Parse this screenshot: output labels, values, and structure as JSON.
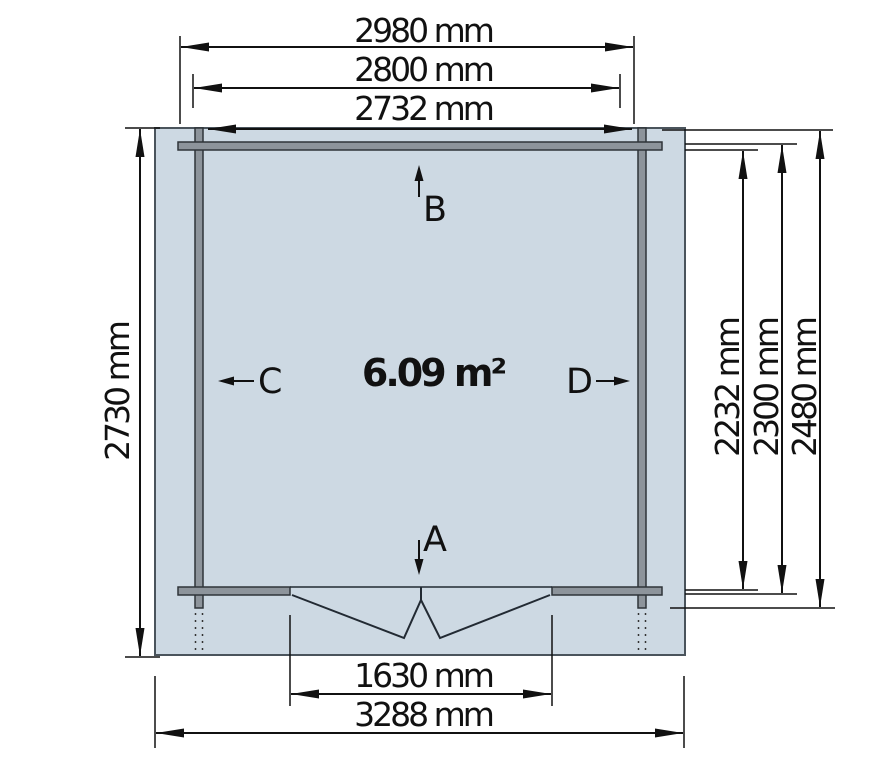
{
  "diagram": {
    "area_label": "6.09 m²",
    "opening_labels": {
      "a": "A",
      "b": "B",
      "c": "C",
      "d": "D"
    },
    "dimensions": {
      "top_outer": "2980 mm",
      "top_middle": "2800 mm",
      "top_inner": "2732 mm",
      "left": "2730 mm",
      "right_inner": "2232 mm",
      "right_middle": "2300 mm",
      "right_outer": "2480 mm",
      "bottom_door": "1630 mm",
      "bottom_outer": "3288 mm"
    },
    "colors": {
      "slab": "#cdd9e3",
      "wall": "#8d949b",
      "line": "#111111"
    }
  }
}
